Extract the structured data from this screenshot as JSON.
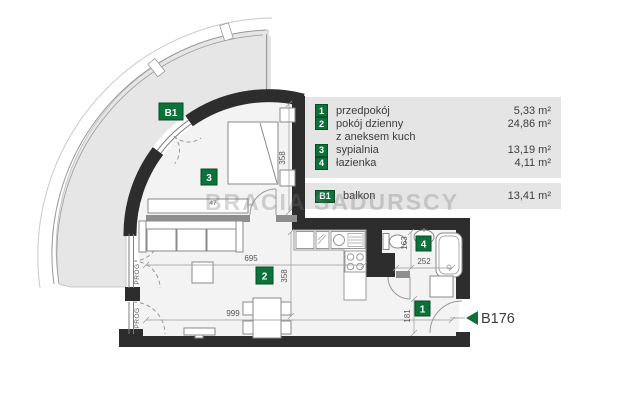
{
  "watermark": "BRACIA SADURSCY",
  "unit": {
    "code": "B176"
  },
  "colors": {
    "accent_green": "#0b7239",
    "wall": "#2d2d2d",
    "legend_bg": "#e5e5e5"
  },
  "legend": {
    "rows": [
      {
        "badge": "1",
        "name": "przedpokój",
        "area": "5,33 m²"
      },
      {
        "badge": "2",
        "name": "pokój dzienny",
        "area": "24,86 m²"
      },
      {
        "badge": "",
        "name": "z aneksem kuch",
        "area": ""
      },
      {
        "badge": "3",
        "name": "sypialnia",
        "area": "13,19 m²"
      },
      {
        "badge": "4",
        "name": "łazienka",
        "area": "4,11 m²"
      }
    ],
    "balcony_row": {
      "badge": "B1",
      "name": "balkon",
      "area": "13,41 m²"
    }
  },
  "plan_badges": {
    "hallway": "1",
    "living": "2",
    "bedroom": "3",
    "bathroom": "4",
    "balcony": "B1"
  },
  "dimensions": {
    "living_width": "695",
    "total_width": "999",
    "bedroom_depth": "358",
    "living_depth": "358",
    "bathroom_depth": "163",
    "bathroom_width": "252",
    "hallway_depth": "181",
    "wardrobe_width": "47"
  },
  "labels": {
    "threshold": "PRÓG"
  }
}
